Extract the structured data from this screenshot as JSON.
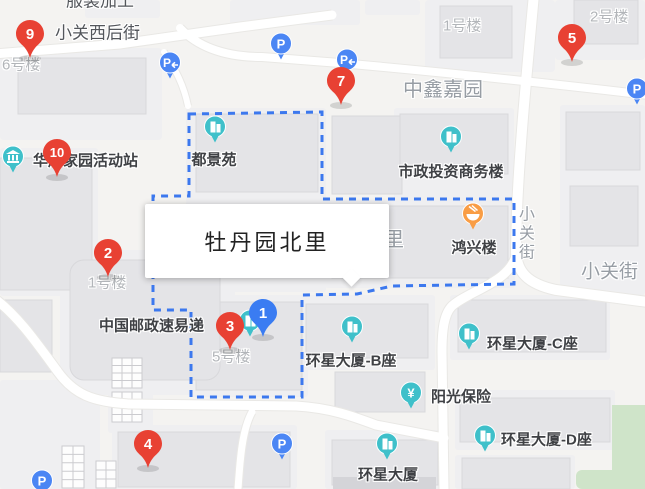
{
  "colors": {
    "marker_red": "#e84133",
    "marker_blue": "#3a7cf2",
    "poi_teal": "#3fc0ca",
    "poi_orange": "#f99d45",
    "parking_blue": "#4b86f4",
    "boundary_blue": "#3c78ee",
    "label_dark": "#3f4145",
    "label_gray": "#b2b5b9",
    "label_area": "#979da4",
    "label_street": "#53565b"
  },
  "infobox": {
    "text": "牡丹园北里"
  },
  "markers": [
    {
      "label": "1",
      "type": "blue",
      "x": 263,
      "y": 312
    },
    {
      "label": "2",
      "type": "red",
      "x": 108,
      "y": 252
    },
    {
      "label": "3",
      "type": "red",
      "x": 230,
      "y": 325
    },
    {
      "label": "4",
      "type": "red",
      "x": 148,
      "y": 443
    },
    {
      "label": "5",
      "type": "red",
      "x": 572,
      "y": 37
    },
    {
      "label": "7",
      "type": "red",
      "x": 341,
      "y": 80
    },
    {
      "label": "9",
      "type": "red",
      "x": 30,
      "y": 33
    },
    {
      "label": "10",
      "type": "red",
      "x": 57,
      "y": 152
    }
  ],
  "pois": [
    {
      "label": "华严家园活动站",
      "icon": "museum",
      "ix": 13,
      "iy": 160,
      "lx": 33,
      "ly": 161,
      "anchor": "l"
    },
    {
      "label": "都景苑",
      "icon": "building",
      "ix": 215,
      "iy": 130,
      "lx": 214,
      "ly": 160,
      "anchor": "c"
    },
    {
      "label": "市政投资商务楼",
      "icon": "building",
      "ix": 451,
      "iy": 140,
      "lx": 451,
      "ly": 172,
      "anchor": "c"
    },
    {
      "label": "鸿兴楼",
      "icon": "food",
      "ix": 473,
      "iy": 217,
      "lx": 474,
      "ly": 248,
      "anchor": "c"
    },
    {
      "label": "中国邮政速易递",
      "icon": "none",
      "lx": 99,
      "ly": 326,
      "anchor": "l"
    },
    {
      "label": "环星大厦-B座",
      "icon": "building",
      "ix": 352,
      "iy": 330,
      "lx": 351,
      "ly": 361,
      "anchor": "c"
    },
    {
      "label": "环星大厦-C座",
      "icon": "building",
      "ix": 469,
      "iy": 337,
      "lx": 487,
      "ly": 344,
      "anchor": "l"
    },
    {
      "label": "阳光保险",
      "icon": "yen",
      "ix": 411,
      "iy": 396,
      "lx": 431,
      "ly": 397,
      "anchor": "l"
    },
    {
      "label": "环星大厦",
      "icon": "building",
      "ix": 387,
      "iy": 447,
      "lx": 388,
      "ly": 475,
      "anchor": "c"
    },
    {
      "label": "环星大厦-D座",
      "icon": "building",
      "ix": 485,
      "iy": 439,
      "lx": 501,
      "ly": 440,
      "anchor": "l"
    },
    {
      "label": "",
      "icon": "building",
      "ix": 250,
      "iy": 324,
      "lx": 0,
      "ly": 0,
      "anchor": "c"
    }
  ],
  "labels": [
    {
      "text": "服装加工",
      "x": 100,
      "y": 1,
      "size": 17,
      "cls": "street",
      "anchor": "c"
    },
    {
      "text": "小关西后街",
      "x": 55,
      "y": 33,
      "size": 17,
      "cls": "street",
      "anchor": "l"
    },
    {
      "text": "6号楼",
      "x": 2,
      "y": 65,
      "size": 15,
      "cls": "gray",
      "anchor": "l"
    },
    {
      "text": "1号楼",
      "x": 443,
      "y": 26,
      "size": 15,
      "cls": "gray",
      "anchor": "l"
    },
    {
      "text": "2号楼",
      "x": 590,
      "y": 17,
      "size": 15,
      "cls": "gray",
      "anchor": "l"
    },
    {
      "text": "中鑫嘉园",
      "x": 403,
      "y": 90,
      "size": 20,
      "cls": "area",
      "anchor": "l"
    },
    {
      "text": "里",
      "x": 384,
      "y": 240,
      "size": 20,
      "cls": "area",
      "anchor": "l"
    },
    {
      "text": "小关街",
      "x": 524,
      "y": 234,
      "size": 16,
      "cls": "area",
      "anchor": "c",
      "vertical": true
    },
    {
      "text": "小关街",
      "x": 581,
      "y": 272,
      "size": 19,
      "cls": "area",
      "anchor": "l"
    },
    {
      "text": "1号楼",
      "x": 88,
      "y": 283,
      "size": 15,
      "cls": "gray",
      "anchor": "l"
    },
    {
      "text": "5号楼",
      "x": 212,
      "y": 357,
      "size": 15,
      "cls": "gray",
      "anchor": "l"
    }
  ],
  "parking": {
    "glyph": "P",
    "spots": [
      {
        "x": 170,
        "y": 66,
        "arrow": true
      },
      {
        "x": 281,
        "y": 47,
        "arrow": false
      },
      {
        "x": 347,
        "y": 63,
        "arrow": true
      },
      {
        "x": 637,
        "y": 92,
        "arrow": false
      },
      {
        "x": 282,
        "y": 447,
        "arrow": false
      },
      {
        "x": 42,
        "y": 484,
        "arrow": false
      }
    ]
  }
}
